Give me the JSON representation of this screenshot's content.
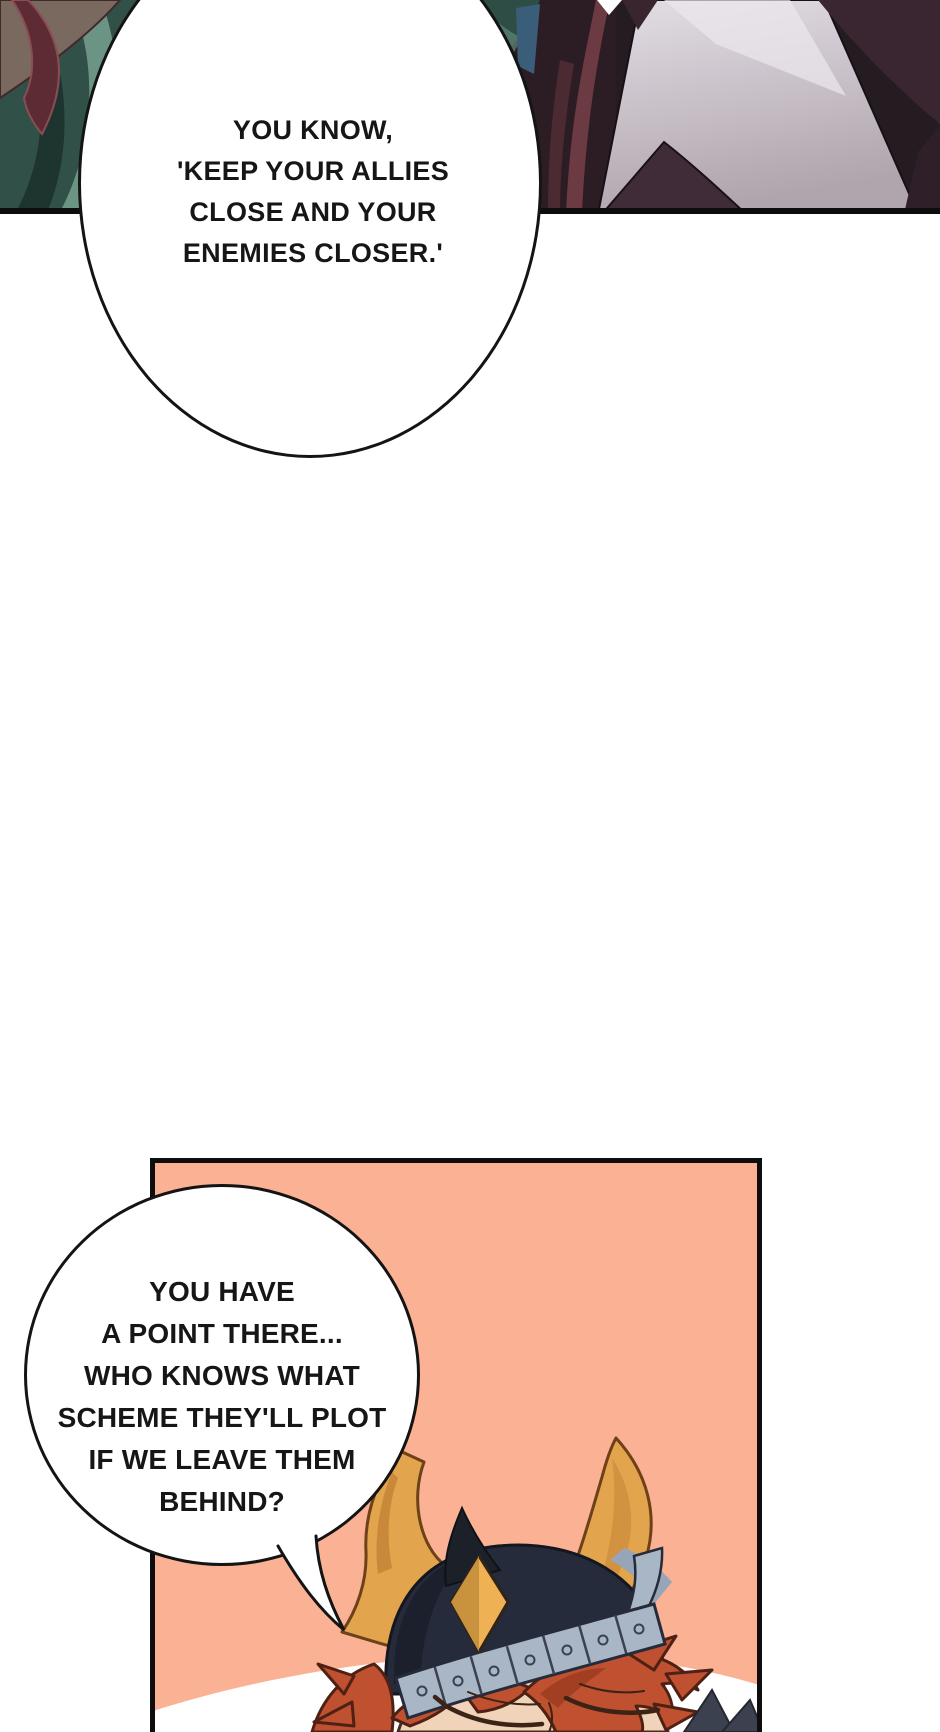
{
  "comic": {
    "top_bubble": {
      "lines": [
        "YOU KNOW,",
        "'KEEP YOUR ALLIES",
        "CLOSE AND YOUR",
        "ENEMIES CLOSER.'"
      ]
    },
    "bottom_bubble": {
      "lines": [
        "YOU HAVE",
        "A POINT THERE...",
        "WHO KNOWS WHAT",
        "SCHEME THEY'LL PLOT",
        "IF WE LEAVE THEM",
        "BEHIND?"
      ]
    }
  },
  "colors": {
    "page_bg": "#ffffff",
    "panel_border": "#0d0d0d",
    "bubble_fill": "#ffffff",
    "bubble_outline": "#141414",
    "speech_text": "#161616",
    "bottom_panel_bg": "#fbb294",
    "white_backdrop": "#ffffff",
    "horn_gold": "#e2a44c",
    "horn_shadow": "#c9883a",
    "helmet_navy": "#262b3b",
    "helmet_shadow": "#1b202c",
    "band_slate": "#a9b6c6",
    "band_line": "#3a4150",
    "hair_rust": "#bf5130",
    "hair_shadow": "#9e3d22",
    "hair_outline": "#4f2114",
    "skin_tan": "#f0d3b8",
    "face_line": "#3b2315",
    "hair_teal": "#315047",
    "hair_teal_light": "#6d9485",
    "hair_teal_dark": "#1e352f",
    "ribbon_maroon": "#5d2b33",
    "corner_brown": "#7a695e",
    "fabric_dark_maroon": "#2c1d24",
    "fabric_maroon_light": "#6b3a42",
    "fabric_lavender_hi": "#e3dee5",
    "fabric_lavender_lo": "#b0a4ad",
    "fabric_plum": "#3a2630",
    "fabric_plum_wedge": "#402c38",
    "steel_blue": "#3a5e7a",
    "spike_charcoal": "#3c4150"
  }
}
